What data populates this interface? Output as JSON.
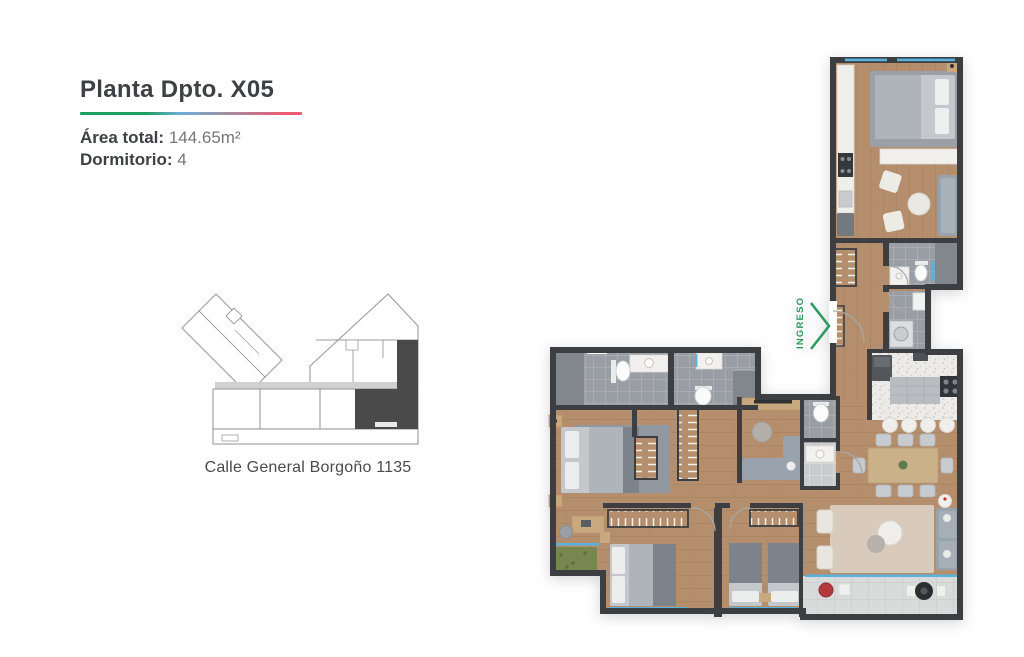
{
  "header": {
    "title": "Planta Dpto. X05",
    "area": {
      "label": "Área total:",
      "value": "144.65m²"
    },
    "dormitory": {
      "label": "Dormitorio:",
      "value": "4"
    }
  },
  "key_plan": {
    "caption": "Calle General Borgoño 1135"
  },
  "floor_plan": {
    "entrance": {
      "label": "INGRESO"
    }
  },
  "colors": {
    "ink": "#3f4043",
    "muted": "#767676",
    "acc-green": "#1e9e62",
    "acc-blue": "#6fadd6",
    "acc-purple": "#9b93a8",
    "acc-pink": "#ee5a72",
    "entrance": "#2e9a5f",
    "kp-line": "#9b9b9b",
    "kp-dark": "#4a4a4a",
    "wall": "#3c3e42",
    "wood": "#b58f6d",
    "wood-dark": "#a9835f",
    "wood-furn": "#c8a87e",
    "tile": "#989ea4",
    "tile-dark": "#81878d",
    "tile-light": "#c9cccd",
    "terrace": "#d9dbda",
    "counter": "#efeeea",
    "terrazzo": "#ecebe7",
    "rug": "#d8cbbc",
    "rug-gray": "#9198a0",
    "sofa": "#99a3ad",
    "bed": "#c4c8cc",
    "bed-dark": "#aeb4ba",
    "quilt": "#7d838a",
    "window": "#58b2de",
    "table-wood": "#cbb189",
    "chair": "#c6cbd0",
    "accent-red": "#b23a3c",
    "grill": "#2c2e30",
    "plant": "#76874f",
    "white-fix": "#fbfbfb"
  }
}
